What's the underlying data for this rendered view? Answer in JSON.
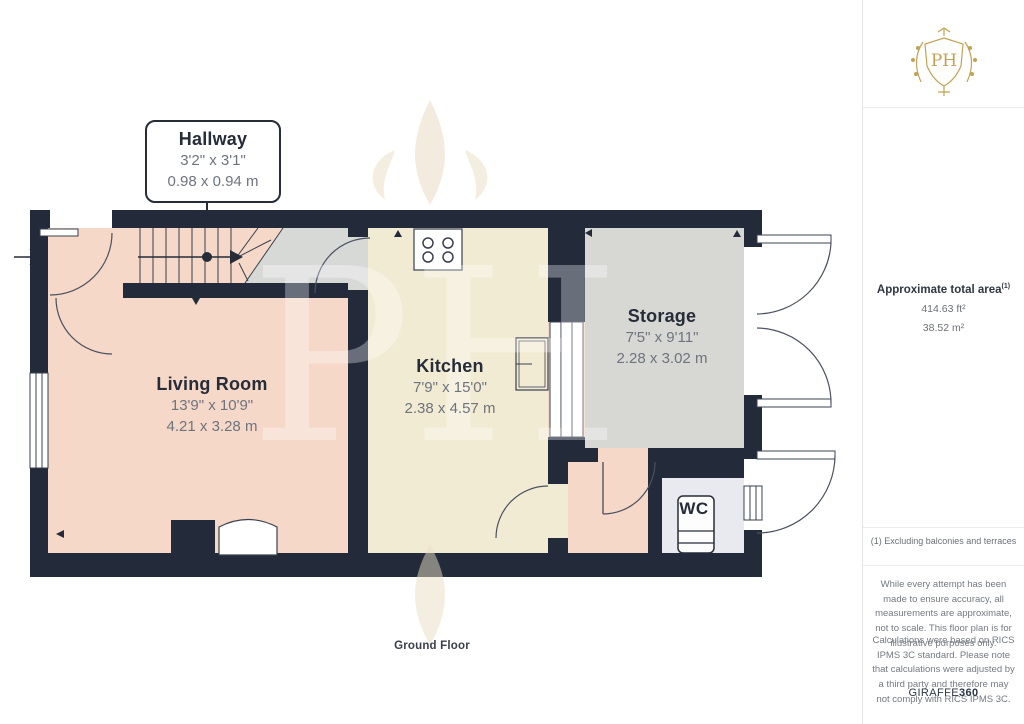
{
  "floor_plan": {
    "title": "Ground Floor",
    "rooms": [
      {
        "name": "Hallway",
        "imperial": "3'2\" x 3'1\"",
        "metric": "0.98 x 0.94 m"
      },
      {
        "name": "Living Room",
        "imperial": "13'9\" x 10'9\"",
        "metric": "4.21 x 3.28 m"
      },
      {
        "name": "Kitchen",
        "imperial": "7'9\" x 15'0\"",
        "metric": "2.38 x 4.57 m"
      },
      {
        "name": "Storage",
        "imperial": "7'5\" x 9'11\"",
        "metric": "2.28 x 3.02 m"
      },
      {
        "name": "WC",
        "imperial": "",
        "metric": ""
      }
    ],
    "watermark_monogram": "PH"
  },
  "sidebar": {
    "logo_monogram": "PH",
    "area": {
      "title": "Approximate total area",
      "superscript": "(1)",
      "imperial": "414.63 ft²",
      "metric": "38.52 m²"
    },
    "footnote": "(1) Excluding balconies and terraces",
    "disclaimers": [
      "While every attempt has been made to ensure accuracy, all measurements are approximate, not to scale. This floor plan is for illustrative purposes only.",
      "Calculations were based on RICS IPMS 3C standard. Please note that calculations were adjusted by a third party and therefore may not comply with RICS IPMS 3C."
    ],
    "brand": {
      "name": "GIRAFFE",
      "suffix": "360"
    }
  },
  "colors": {
    "wall": "#232b3b",
    "floor_pink": "#f5d8c8",
    "floor_cream": "#f2ebd3",
    "floor_gray": "#d7d7d4",
    "floor_wc": "#e8eaef",
    "brand_gold": "#c2a253",
    "dim_text": "#6e747e",
    "label_text": "#262c38"
  }
}
